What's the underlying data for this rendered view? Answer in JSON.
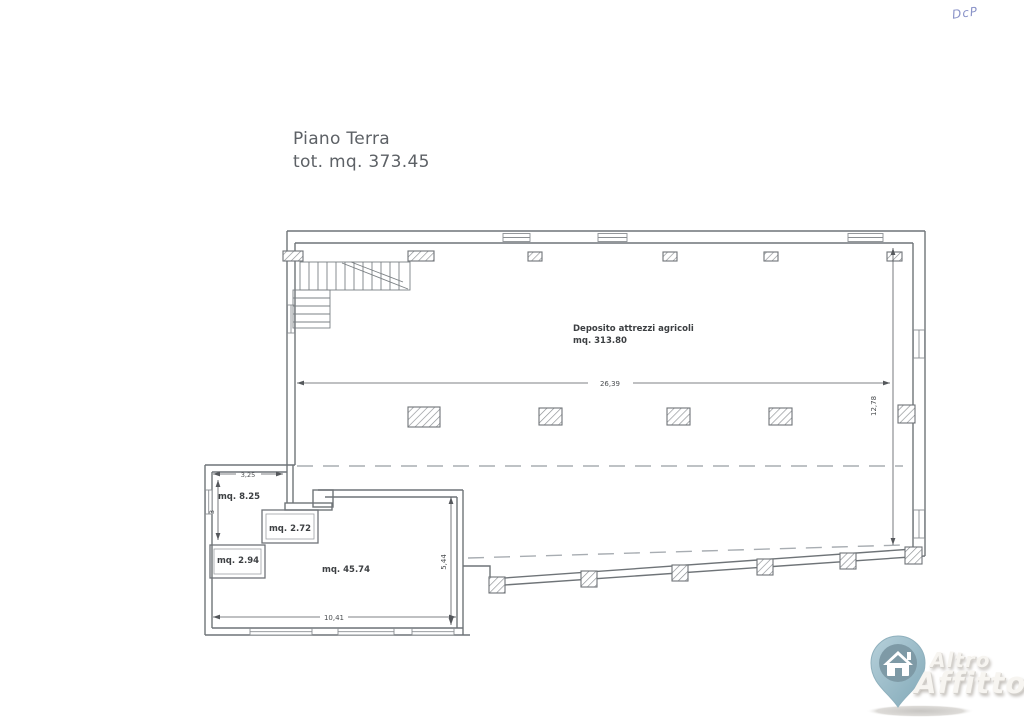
{
  "title": {
    "line1": "Piano Terra",
    "line2": "tot. mq. 373.45"
  },
  "handwritten_note": "DcP",
  "plan": {
    "main_room": {
      "name": "Deposito attrezzi agricoli",
      "area": "mq. 313.80"
    },
    "rooms": [
      {
        "area": "mq. 8.25"
      },
      {
        "area": "mq. 2.72"
      },
      {
        "area": "mq. 2.94"
      },
      {
        "area": "mq. 45.74"
      }
    ],
    "dimensions": {
      "hall_width": "26,39",
      "hall_height": "12,78",
      "storage_width": "3,25",
      "storage_height": "3",
      "annex_width": "10,41",
      "annex_height": "5,44"
    }
  },
  "watermark": {
    "line1": "Altro",
    "line2": "Affitto"
  },
  "colors": {
    "wall_line": "#6f7478",
    "dimension_line": "#55585c",
    "dashed_line": "#a8adb2",
    "title_text": "#5d6166",
    "note_ink": "#8a93c8",
    "pin_fill": "#9ebfcc",
    "pin_circle": "#7e9aa6",
    "logo_text": "#f7f5f1"
  }
}
